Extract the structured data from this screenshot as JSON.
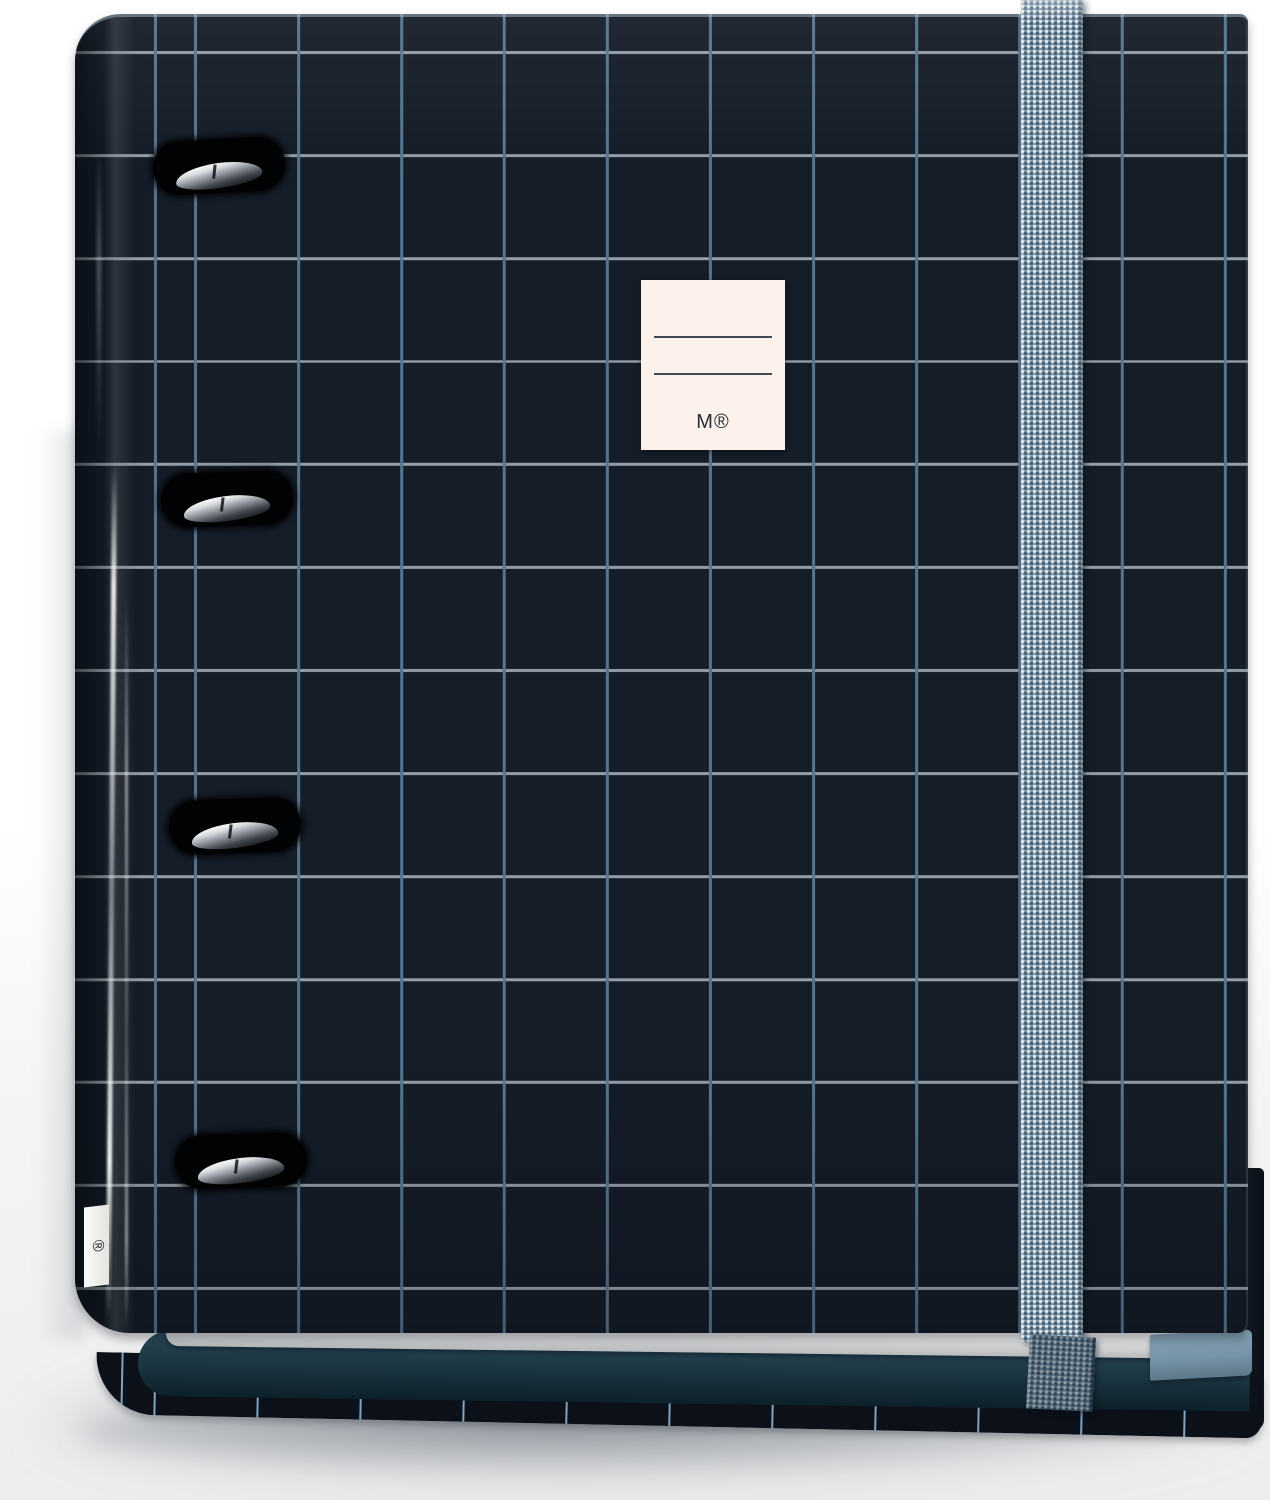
{
  "product": {
    "label": {
      "brand_mark": "M®",
      "lines": [
        "",
        ""
      ]
    },
    "spine_mark": "®"
  },
  "colors": {
    "cover": "#151d29",
    "grid_v": "#56748f",
    "grid_h": "#929ca6",
    "band": "#7d98ab",
    "label_bg": "#fdf1ec",
    "label_text": "#252f3b",
    "pages": "#d7d8d9",
    "tab": "#7793a7",
    "back_cover": "#0b1019",
    "back_grid": "#7fa3c2"
  }
}
